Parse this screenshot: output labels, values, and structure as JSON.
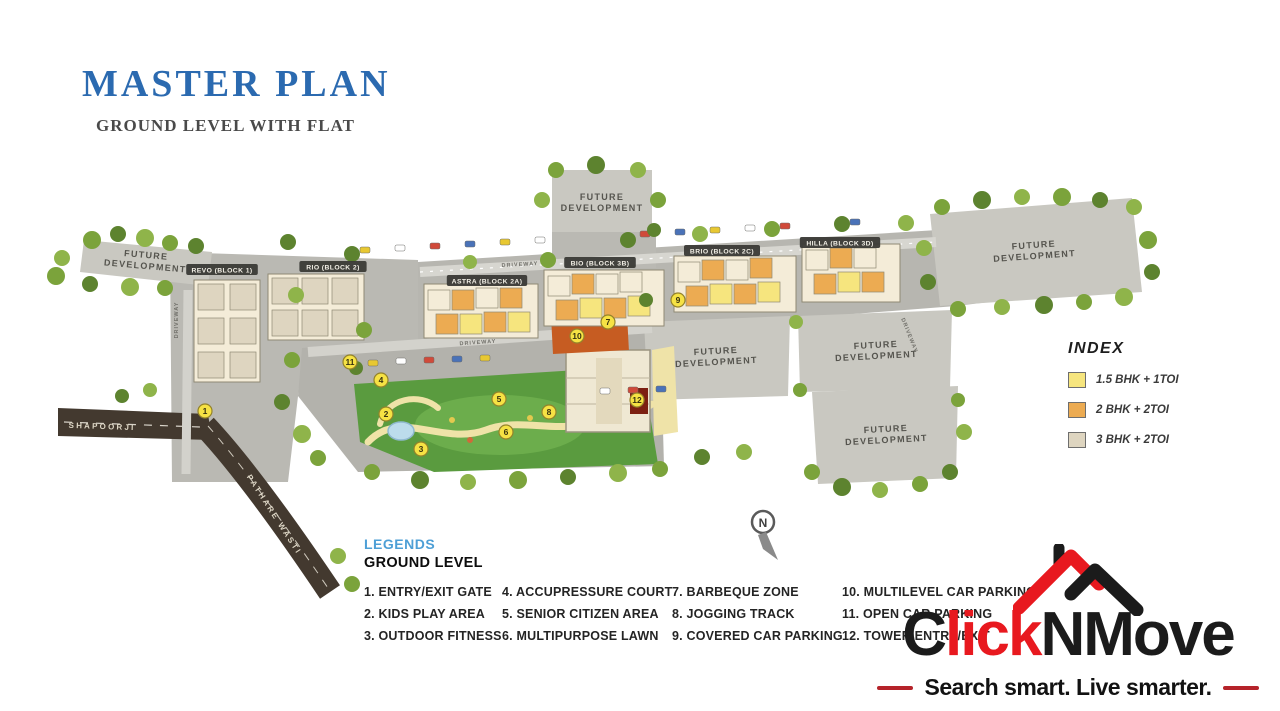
{
  "header": {
    "title": "MASTER PLAN",
    "subtitle": "GROUND LEVEL WITH FLAT"
  },
  "colors": {
    "title_blue": "#2b6ab0",
    "legend_blue": "#4d9fd6",
    "logo_red": "#e8191f",
    "logo_black": "#1b1b1b",
    "flat_yellow": "#f6e57e",
    "flat_orange": "#ecab52",
    "flat_beige": "#ded5c0"
  },
  "map": {
    "future_label": "FUTURE DEVELOPMENT",
    "future_areas": [
      {
        "x": 146,
        "y": 258,
        "rot": 5
      },
      {
        "x": 602,
        "y": 200,
        "rot": 0
      },
      {
        "x": 1034,
        "y": 248,
        "rot": -4
      },
      {
        "x": 716,
        "y": 354,
        "rot": -3
      },
      {
        "x": 876,
        "y": 348,
        "rot": -3
      },
      {
        "x": 886,
        "y": 432,
        "rot": -3
      }
    ],
    "blocks": [
      {
        "label": "REVO (BLOCK 1)",
        "x": 222,
        "y": 271
      },
      {
        "label": "RIO (BLOCK 2)",
        "x": 333,
        "y": 268
      },
      {
        "label": "ASTRA (BLOCK 2A)",
        "x": 487,
        "y": 282
      },
      {
        "label": "BIO (BLOCK 3B)",
        "x": 600,
        "y": 264
      },
      {
        "label": "BRIO (BLOCK 2C)",
        "x": 722,
        "y": 252
      },
      {
        "label": "HILLA (BLOCK 3D)",
        "x": 840,
        "y": 244
      }
    ],
    "roads": [
      {
        "label": "SHAPOORJI",
        "x": 102,
        "y": 429,
        "rot": 2,
        "type": "main"
      },
      {
        "label": "PATHARE WASTI",
        "x": 272,
        "y": 516,
        "rot": 57,
        "type": "main"
      },
      {
        "label": "DRIVEWAY",
        "x": 178,
        "y": 320,
        "rot": -90,
        "type": "drive"
      },
      {
        "label": "DRIVEWAY",
        "x": 520,
        "y": 266,
        "rot": -3,
        "type": "drive"
      },
      {
        "label": "DRIVEWAY",
        "x": 478,
        "y": 344,
        "rot": -4,
        "type": "drive"
      },
      {
        "label": "DRIVEWAY",
        "x": 908,
        "y": 336,
        "rot": 68,
        "type": "drive"
      }
    ],
    "markers": [
      {
        "n": "1",
        "x": 205,
        "y": 411
      },
      {
        "n": "2",
        "x": 386,
        "y": 414
      },
      {
        "n": "3",
        "x": 421,
        "y": 449
      },
      {
        "n": "4",
        "x": 381,
        "y": 380
      },
      {
        "n": "5",
        "x": 499,
        "y": 399
      },
      {
        "n": "6",
        "x": 506,
        "y": 432
      },
      {
        "n": "7",
        "x": 608,
        "y": 322
      },
      {
        "n": "8",
        "x": 549,
        "y": 412
      },
      {
        "n": "9",
        "x": 678,
        "y": 300
      },
      {
        "n": "10",
        "x": 577,
        "y": 336
      },
      {
        "n": "11",
        "x": 350,
        "y": 362
      },
      {
        "n": "12",
        "x": 637,
        "y": 400
      }
    ],
    "compass_label": "N"
  },
  "index": {
    "title": "INDEX",
    "items": [
      {
        "label": "1.5 BHK + 1TOI",
        "color": "#f6e57e"
      },
      {
        "label": "2 BHK + 2TOI",
        "color": "#ecab52"
      },
      {
        "label": "3 BHK + 2TOI",
        "color": "#ded5c0"
      }
    ]
  },
  "legends": {
    "title": "LEGENDS",
    "subtitle": "GROUND LEVEL",
    "items": [
      "1. ENTRY/EXIT GATE",
      "2. KIDS PLAY AREA",
      "3. OUTDOOR FITNESS",
      "4. ACCUPRESSURE COURT",
      "5. SENIOR CITIZEN AREA",
      "6. MULTIPURPOSE LAWN",
      "7. BARBEQUE ZONE",
      "8. JOGGING TRACK",
      "9. COVERED CAR PARKING",
      "10. MULTILEVEL CAR PARKING",
      "11. OPEN CAR PARKING",
      "12. TOWER ENTRY/EXIT"
    ]
  },
  "logo": {
    "parts": [
      {
        "text": "C",
        "color": "#1b1b1b"
      },
      {
        "text": "lick",
        "color": "#e8191f"
      },
      {
        "text": "NMove",
        "color": "#1b1b1b"
      }
    ],
    "tagline": "Search smart. Live smarter."
  }
}
